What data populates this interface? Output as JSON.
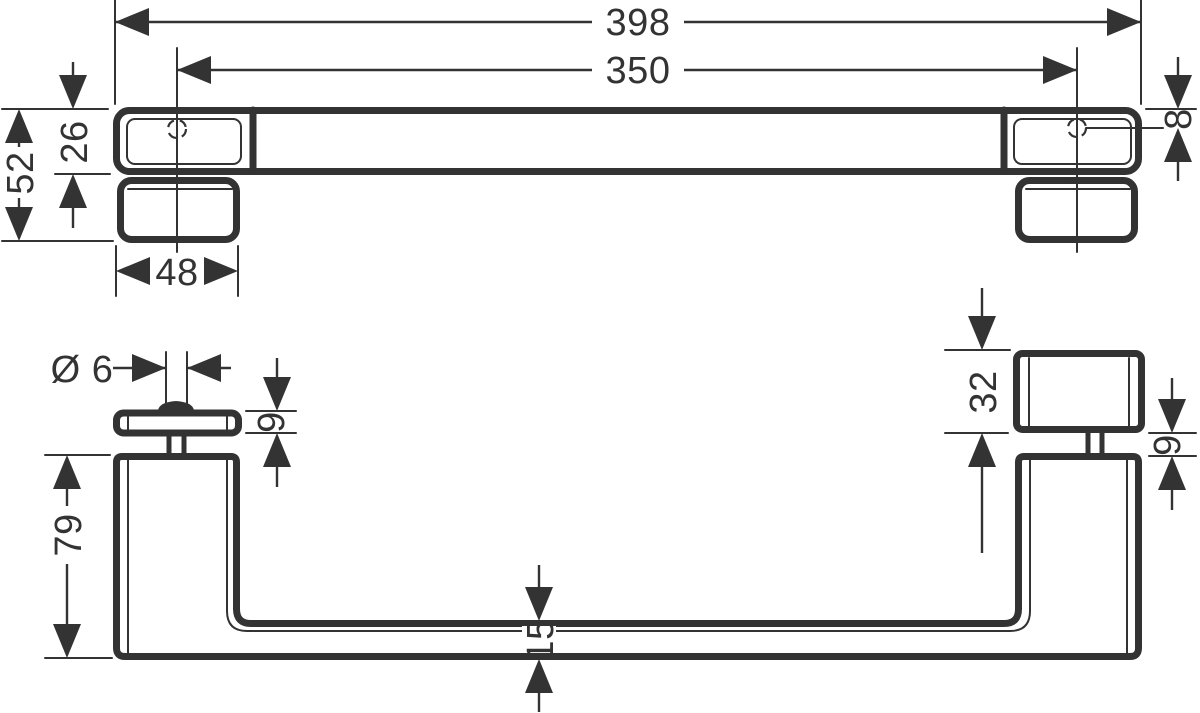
{
  "drawing": {
    "background_color": "#ffffff",
    "line_color": "#333333",
    "views": {
      "top": {
        "overall_length": "398",
        "hole_spacing": "350",
        "end_height": "52",
        "bar_height": "26",
        "plate_width": "48",
        "hole_offset": "8"
      },
      "front": {
        "pin_diameter": "Ø 6",
        "cap_thickness": "9",
        "post_height": "79",
        "block_height": "32",
        "gap": "9",
        "bar_thickness": "15"
      }
    }
  }
}
